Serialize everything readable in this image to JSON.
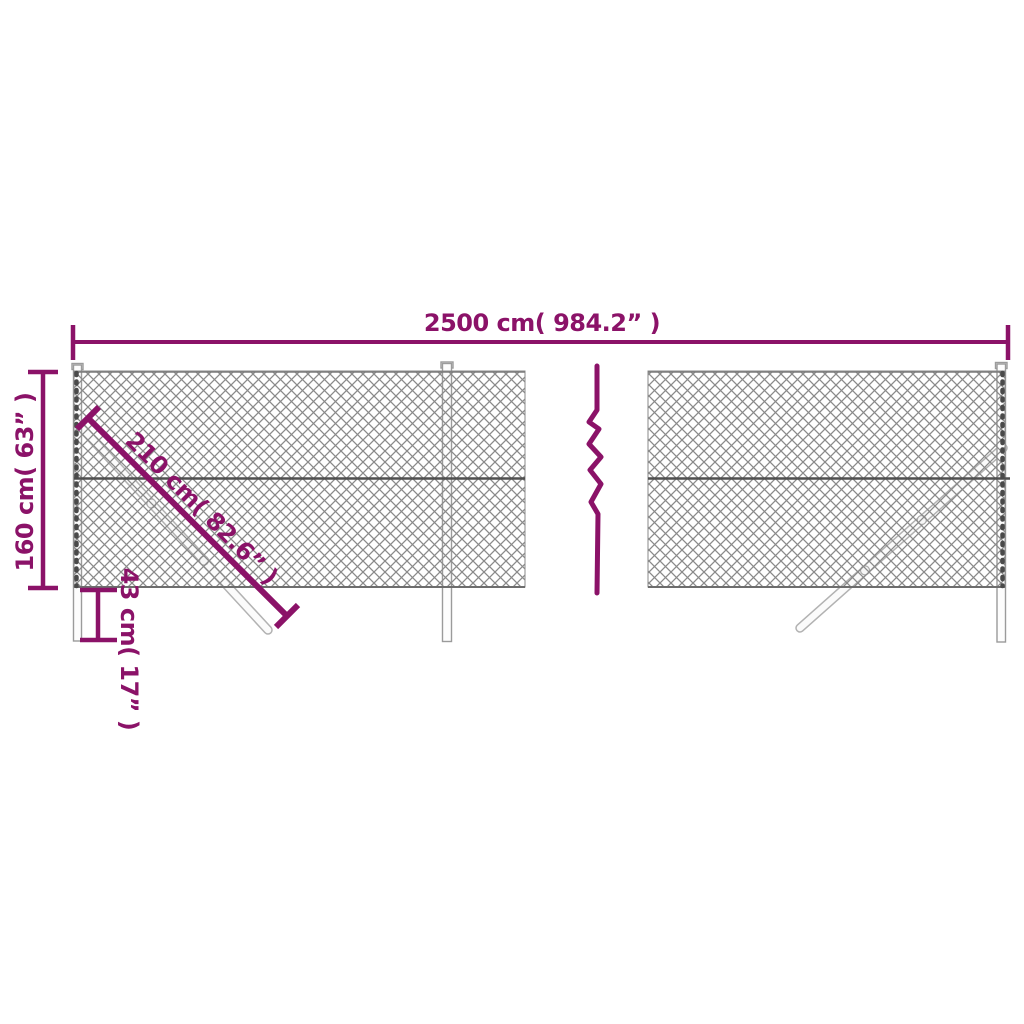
{
  "figure": {
    "kind": "chain-link-fence-dimension-diagram",
    "panels": 2,
    "break_symbol": "vertical-zigzag"
  },
  "labels": {
    "total_width": "2500 cm( 984.2” )",
    "height": "160 cm( 63” )",
    "brace_length": "210 cm( 82.6” )",
    "post_depth": "43 cm( 17” )"
  },
  "values": {
    "total_width_cm": 2500,
    "total_width_in": 984.2,
    "height_cm": 160,
    "height_in": 63,
    "brace_length_cm": 210,
    "brace_length_in": 82.6,
    "post_depth_cm": 43,
    "post_depth_in": 17
  },
  "colors": {
    "dimension": "#8B1268",
    "mesh": "#8a8a8a",
    "tension_wire": "#4f4f4f",
    "post_outline": "#9b9b9b",
    "background": "#ffffff"
  }
}
